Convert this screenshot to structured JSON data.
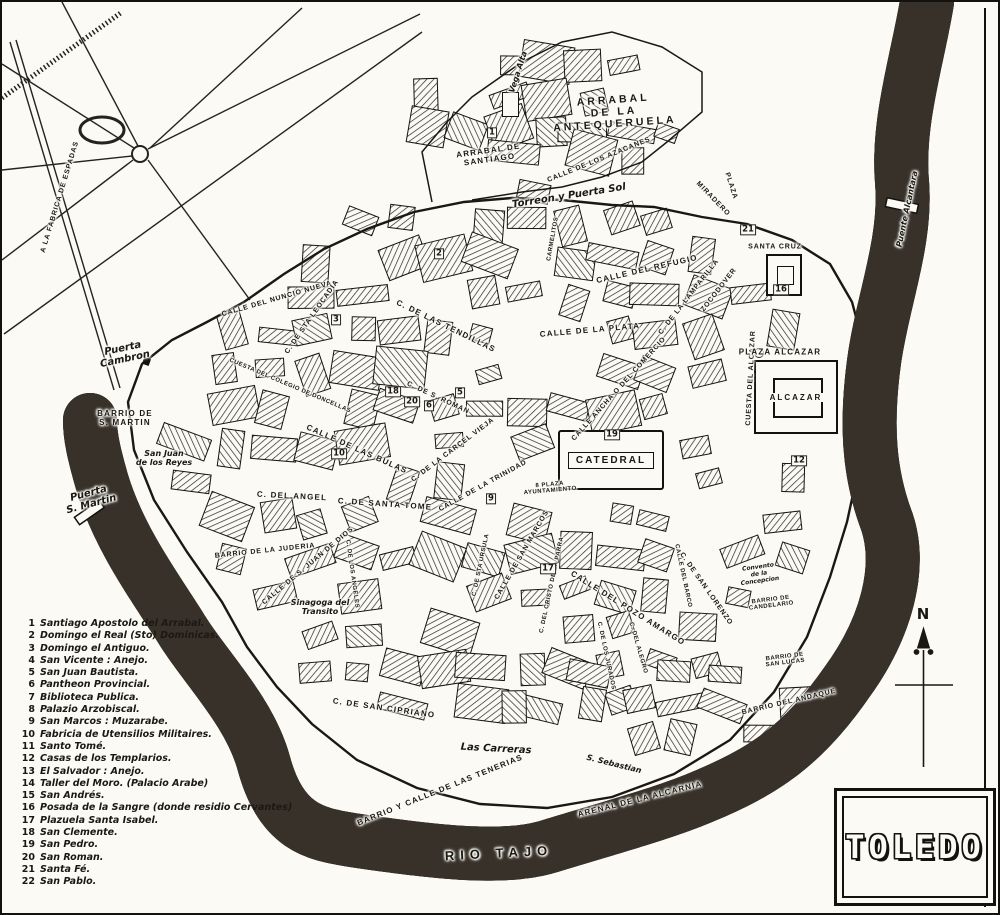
{
  "title": "TOLEDO",
  "colors": {
    "paper": "#fbfaf5",
    "ink": "#1b1813",
    "river_bank": "#383129",
    "river_water": "#f3f1e9"
  },
  "compass": {
    "north_label": "N"
  },
  "landmarks": {
    "catedral": "CATEDRAL",
    "alcazar": "ALCAZAR"
  },
  "legend": {
    "items": [
      {
        "n": "1",
        "t": "Santiago Apostolo del Arrabal."
      },
      {
        "n": "2",
        "t": "Domingo el Real (Sto) Dominicas."
      },
      {
        "n": "3",
        "t": "Domingo el Antiguo."
      },
      {
        "n": "4",
        "t": "San Vicente : Anejo."
      },
      {
        "n": "5",
        "t": "San Juan Bautista."
      },
      {
        "n": "6",
        "t": "Pantheon Provincial."
      },
      {
        "n": "7",
        "t": "Biblioteca Publica."
      },
      {
        "n": "8",
        "t": "Palazio Arzobiscal."
      },
      {
        "n": "9",
        "t": "San Marcos : Muzarabe."
      },
      {
        "n": "10",
        "t": "Fabricia de Utensilios Militaires."
      },
      {
        "n": "11",
        "t": "Santo Tomé."
      },
      {
        "n": "12",
        "t": "Casas de los Templarios."
      },
      {
        "n": "13",
        "t": "El Salvador : Anejo."
      },
      {
        "n": "14",
        "t": "Taller del Moro. (Palacio Arabe)"
      },
      {
        "n": "15",
        "t": "San Andrés."
      },
      {
        "n": "16",
        "t": "Posada de la Sangre (donde residio Cervantes)"
      },
      {
        "n": "17",
        "t": "Plazuela Santa Isabel."
      },
      {
        "n": "18",
        "t": "San Clemente."
      },
      {
        "n": "19",
        "t": "San Pedro."
      },
      {
        "n": "20",
        "t": "San Roman."
      },
      {
        "n": "21",
        "t": "Santa Fé."
      },
      {
        "n": "22",
        "t": "San Pablo."
      }
    ]
  },
  "map": {
    "labels": [
      {
        "text": "A LA FABRICA DE ESPADAS",
        "x": 58,
        "y": 195,
        "rot": -73,
        "style": "capsSm"
      },
      {
        "text": "Vega Alta",
        "x": 516,
        "y": 70,
        "rot": -72,
        "style": "handSm"
      },
      {
        "text": "ARRABAL DE\nSANTIAGO",
        "x": 487,
        "y": 153,
        "rot": -8,
        "style": "caps"
      },
      {
        "text": "ARRABAL\nDE LA\nANTEQUERUELA",
        "x": 612,
        "y": 110,
        "rot": -4,
        "style": "capsLg"
      },
      {
        "text": "CALLE DE LOS AZACANES",
        "x": 597,
        "y": 158,
        "rot": -22,
        "style": "capsSm"
      },
      {
        "text": "Torreon y Puerta Sol",
        "x": 567,
        "y": 194,
        "rot": -9,
        "style": "hand"
      },
      {
        "text": "MIRADERO",
        "x": 711,
        "y": 197,
        "rot": 46,
        "style": "capsSm"
      },
      {
        "text": "PLAZA",
        "x": 729,
        "y": 184,
        "rot": 72,
        "style": "capsSm"
      },
      {
        "text": "CALLE DEL REFUGIO",
        "x": 645,
        "y": 267,
        "rot": -13,
        "style": "caps"
      },
      {
        "text": "C. DE LA LAMPARILLA",
        "x": 687,
        "y": 295,
        "rot": -52,
        "style": "capsSm"
      },
      {
        "text": "ZOCODOVER",
        "x": 717,
        "y": 288,
        "rot": -52,
        "style": "capsSm"
      },
      {
        "text": "SANTA CRUZ",
        "x": 773,
        "y": 245,
        "rot": 0,
        "style": "capsSm"
      },
      {
        "text": "Puente Alcantara",
        "x": 905,
        "y": 207,
        "rot": -78,
        "style": "handSm"
      },
      {
        "text": "CUESTA DEL ALCAZAR",
        "x": 749,
        "y": 376,
        "rot": -87,
        "style": "capsSm"
      },
      {
        "text": "PLAZA ALCAZAR",
        "x": 778,
        "y": 350,
        "rot": 0,
        "style": "caps"
      },
      {
        "text": "CARMELITOS",
        "x": 551,
        "y": 237,
        "rot": -80,
        "style": "capsXs"
      },
      {
        "text": "CALLE DEL NUNCIO NUEVA",
        "x": 275,
        "y": 297,
        "rot": -16,
        "style": "capsSm"
      },
      {
        "text": "C. DE STA LEOCADIA",
        "x": 310,
        "y": 315,
        "rot": -55,
        "style": "capsSm"
      },
      {
        "text": "C. DE LAS TENDILLAS",
        "x": 444,
        "y": 324,
        "rot": 26,
        "style": "caps"
      },
      {
        "text": "CUESTA DEL COLEGIO DE DONCELLAS",
        "x": 288,
        "y": 384,
        "rot": 23,
        "style": "capsXs"
      },
      {
        "text": "CALLE DE LA PLATA",
        "x": 588,
        "y": 328,
        "rot": -5,
        "style": "caps"
      },
      {
        "text": "CALLE ANCHA O DEL COMERCIO",
        "x": 617,
        "y": 387,
        "rot": -48,
        "style": "capsSm"
      },
      {
        "text": "C. DE S. ROMAN",
        "x": 436,
        "y": 396,
        "rot": 25,
        "style": "capsSm"
      },
      {
        "text": "CALLE DE LAS BULAS",
        "x": 355,
        "y": 447,
        "rot": 24,
        "style": "caps"
      },
      {
        "text": "C. DE LA CARCEL VIEJA",
        "x": 451,
        "y": 448,
        "rot": -37,
        "style": "capsSm"
      },
      {
        "text": "CALLE DE LA TRINIDAD",
        "x": 481,
        "y": 484,
        "rot": -29,
        "style": "capsSm"
      },
      {
        "text": "C. DEL ANGEL",
        "x": 290,
        "y": 494,
        "rot": 3,
        "style": "caps"
      },
      {
        "text": "C. DE SANTA TOME",
        "x": 383,
        "y": 502,
        "rot": 4,
        "style": "caps"
      },
      {
        "text": "8 PLAZA\nAYUNTAMIENTO",
        "x": 548,
        "y": 486,
        "rot": -5,
        "style": "capsXs"
      },
      {
        "text": "Puerta\nCambron",
        "x": 122,
        "y": 352,
        "rot": -12,
        "style": "hand"
      },
      {
        "text": "BARRIO DE\nS. MARTIN",
        "x": 123,
        "y": 416,
        "rot": 0,
        "style": "caps"
      },
      {
        "text": "San Juan\nde los Reyes",
        "x": 162,
        "y": 456,
        "rot": 0,
        "style": "handSm"
      },
      {
        "text": "Puerta\nS. Martin",
        "x": 88,
        "y": 497,
        "rot": -15,
        "style": "hand"
      },
      {
        "text": "BARRIO DE LA JUDERIA",
        "x": 263,
        "y": 549,
        "rot": -6,
        "style": "capsSm"
      },
      {
        "text": "CALLE DE S. JUAN DE DIOS",
        "x": 306,
        "y": 564,
        "rot": -40,
        "style": "capsSm"
      },
      {
        "text": "Sinagoga del\nTransito",
        "x": 318,
        "y": 605,
        "rot": 0,
        "style": "handSm"
      },
      {
        "text": "C. DE LOS ANGELES",
        "x": 350,
        "y": 572,
        "rot": 82,
        "style": "capsXs"
      },
      {
        "text": "CALLE DE SAN MARCOS",
        "x": 520,
        "y": 553,
        "rot": -60,
        "style": "capsSm"
      },
      {
        "text": "C. DEL CRISTO DE LA PARRA",
        "x": 550,
        "y": 583,
        "rot": -78,
        "style": "capsXs"
      },
      {
        "text": "C. DE STA URSULA",
        "x": 479,
        "y": 563,
        "rot": -78,
        "style": "capsXs"
      },
      {
        "text": "CALLE DEL POZO AMARGO",
        "x": 626,
        "y": 606,
        "rot": 32,
        "style": "caps"
      },
      {
        "text": "CALLE DEL BARCO",
        "x": 681,
        "y": 574,
        "rot": 78,
        "style": "capsXs"
      },
      {
        "text": "C. DEL ALEGRO",
        "x": 636,
        "y": 646,
        "rot": 74,
        "style": "capsXs"
      },
      {
        "text": "C. DE LOS JURADOS",
        "x": 604,
        "y": 654,
        "rot": 78,
        "style": "capsXs"
      },
      {
        "text": "C. DE SAN LORENZO",
        "x": 704,
        "y": 587,
        "rot": 55,
        "style": "capsSm"
      },
      {
        "text": "Convento\nde la\nConcepcion",
        "x": 757,
        "y": 572,
        "rot": -8,
        "style": "handXs"
      },
      {
        "text": "BARRIO DE\nCANDELARIO",
        "x": 769,
        "y": 601,
        "rot": -7,
        "style": "capsXs"
      },
      {
        "text": "BARRIO DE\nSAN LUCAS",
        "x": 783,
        "y": 658,
        "rot": -7,
        "style": "capsXs"
      },
      {
        "text": "BARRIO DEL ANDAQUE",
        "x": 787,
        "y": 700,
        "rot": -13,
        "style": "capsSm"
      },
      {
        "text": "C. DE SAN CIPRIANO",
        "x": 382,
        "y": 706,
        "rot": 8,
        "style": "caps"
      },
      {
        "text": "Las Carreras",
        "x": 494,
        "y": 747,
        "rot": 3,
        "style": "hand"
      },
      {
        "text": "BARRIO Y CALLE DE LAS TENERIAS",
        "x": 438,
        "y": 788,
        "rot": -22,
        "style": "caps"
      },
      {
        "text": "S. Sebastian",
        "x": 612,
        "y": 762,
        "rot": 14,
        "style": "handSm"
      },
      {
        "text": "ARENAL DE LA ALCARNIA",
        "x": 638,
        "y": 797,
        "rot": -14,
        "style": "caps"
      },
      {
        "text": "RIO TAJO",
        "x": 497,
        "y": 851,
        "rot": -3,
        "style": "river"
      }
    ],
    "markers": [
      {
        "num": "1",
        "x": 490,
        "y": 131
      },
      {
        "num": "2",
        "x": 437,
        "y": 252
      },
      {
        "num": "3",
        "x": 334,
        "y": 318
      },
      {
        "num": "5",
        "x": 458,
        "y": 391
      },
      {
        "num": "6",
        "x": 427,
        "y": 404
      },
      {
        "num": "18",
        "x": 391,
        "y": 390
      },
      {
        "num": "20",
        "x": 410,
        "y": 400
      },
      {
        "num": "10",
        "x": 337,
        "y": 452
      },
      {
        "num": "9",
        "x": 489,
        "y": 497
      },
      {
        "num": "19",
        "x": 610,
        "y": 433
      },
      {
        "num": "17",
        "x": 546,
        "y": 567
      },
      {
        "num": "12",
        "x": 797,
        "y": 459
      },
      {
        "num": "16",
        "x": 779,
        "y": 288
      },
      {
        "num": "21",
        "x": 746,
        "y": 228
      }
    ]
  }
}
